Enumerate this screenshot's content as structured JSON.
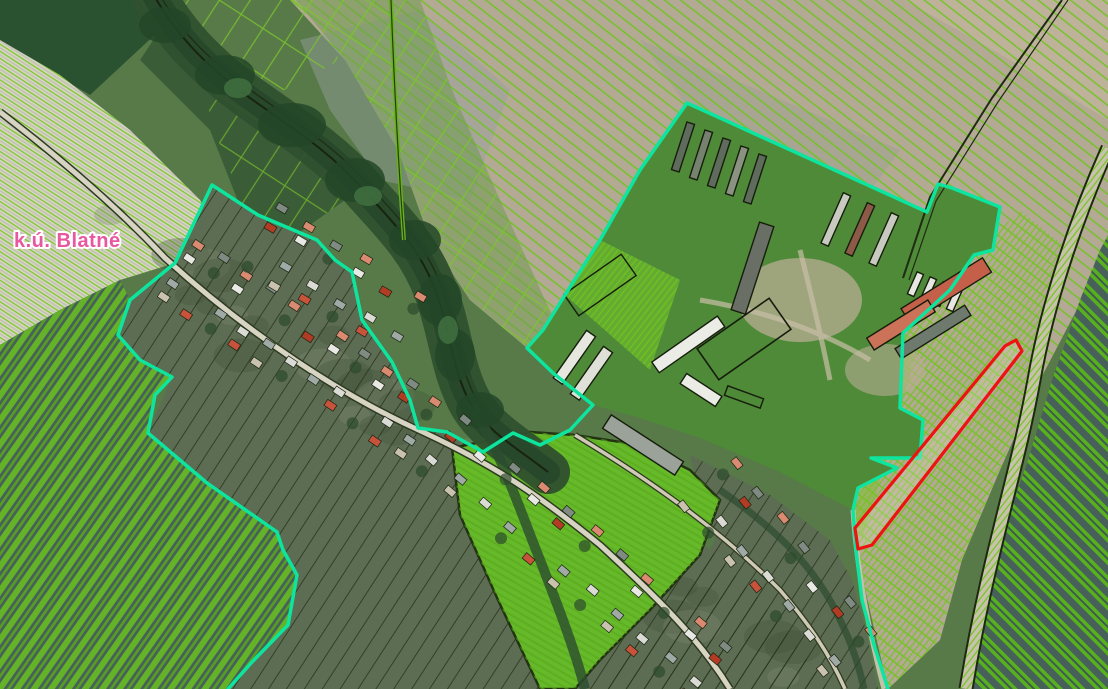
{
  "app": {
    "type": "cadastral-map-viewer"
  },
  "map": {
    "territory_label": {
      "text": "k.ú. Blatné",
      "text_color": "#e8579f",
      "halo_color": "#ffffff"
    },
    "features": {
      "cadastral_boundary": {
        "label": "cadastral territory boundary",
        "color": "#0de59f"
      },
      "highlighted_parcel": {
        "label": "highlighted parcel",
        "color": "#ee1212"
      },
      "parcel_hatch": {
        "label": "parcel hatch lines",
        "color": "#74c41e"
      },
      "parcel_outlines": {
        "label": "parcel outlines",
        "color": "#22300f"
      },
      "road": {
        "label": "road",
        "color": "#c7c2ac"
      },
      "tree_corridor": {
        "label": "stream tree corridor",
        "color": "#30512f"
      },
      "field_bright": {
        "label": "green field",
        "color": "#62b424"
      },
      "field_plowed": {
        "label": "plowed field",
        "color": "#b3a995"
      }
    }
  }
}
